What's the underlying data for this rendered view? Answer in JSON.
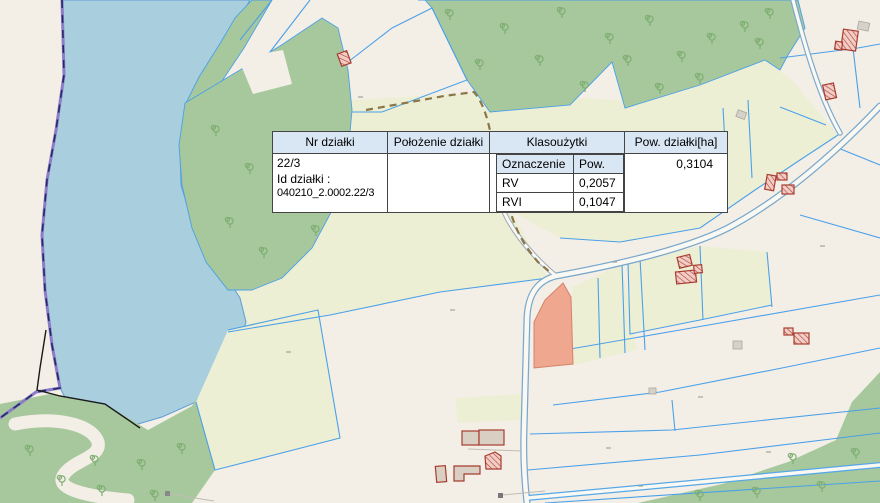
{
  "popup": {
    "header": [
      "Nr działki",
      "Położenie działki",
      "Klasoużytki",
      "Pow. działki[ha]"
    ],
    "nr": "22/3",
    "id_label": "Id działki :",
    "id_value": "040210_2.0002.22/3",
    "polozenie": "",
    "area": "0,3104",
    "sub_header": [
      "Oznaczenie",
      "Pow."
    ],
    "sub_rows": [
      [
        "RV",
        "0,2057"
      ],
      [
        "RVI",
        "0,1047"
      ]
    ]
  },
  "colors": {
    "water": "#a9cede",
    "water_edge": "#5d9fd4",
    "land": "#f3efe7",
    "field": "#edefd5",
    "forest": "#a6c89c",
    "tree": "#7fae72",
    "parcel_line": "#4ba0e8",
    "road_casing": "#7aa8cc",
    "road_fill": "#faf8f2",
    "boundary_purple": "#8b7cc8",
    "boundary_navy": "#232a6a",
    "black_line": "#1a1a1a",
    "path_dash": "#8a7648",
    "selected_fill": "#efa78f",
    "selected_edge": "#d4826a",
    "building_outline": "#a83c30",
    "building_hatch_bg": "#f2cdc5",
    "building_beige": "#d9cfc2",
    "shed_gray": "#d6d2ca",
    "popup_header_bg": "#d9e6f4",
    "popup_border": "#444444",
    "label_gray": "#9aa89a"
  }
}
